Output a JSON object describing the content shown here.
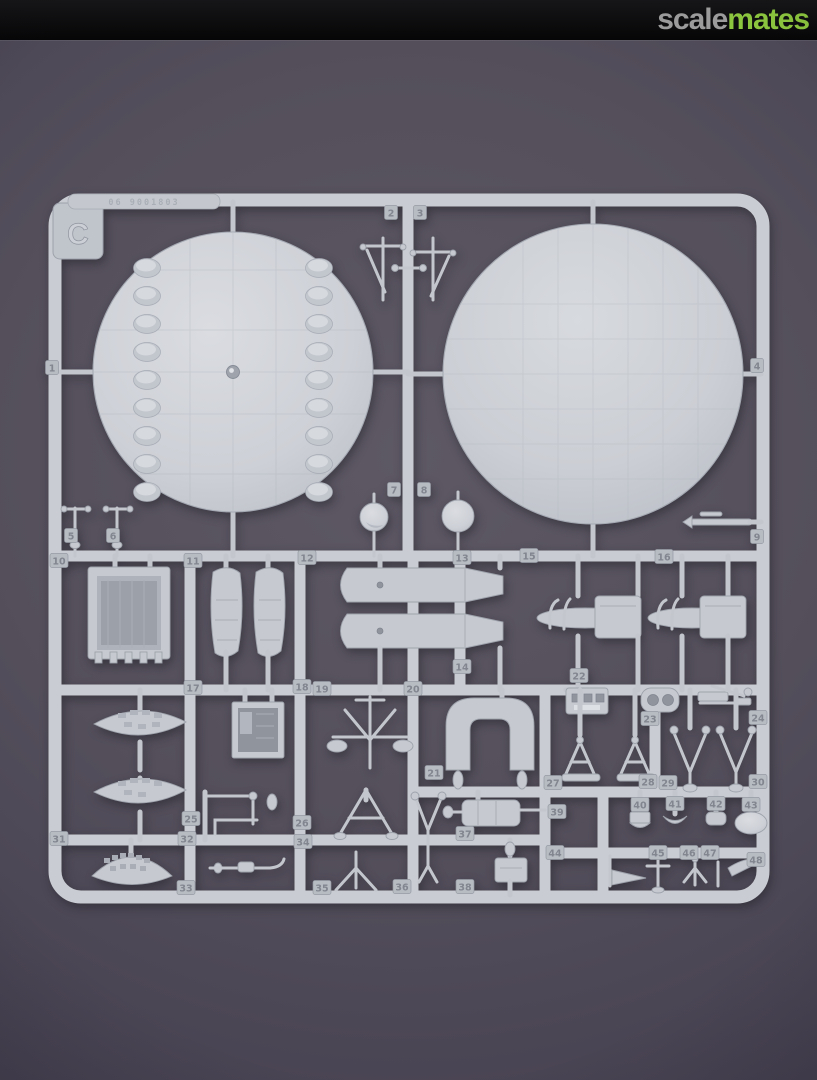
{
  "header": {
    "logo_scale": "scale",
    "logo_mates": "mates",
    "bar_color": "#0b0b0c",
    "scale_color": "#9b9b9b",
    "mates_color": "#8cc63e"
  },
  "background": {
    "center_color": "#5d5864",
    "edge_color": "#393540"
  },
  "sprue": {
    "letter": "C",
    "embossed_code": "06 9001803",
    "plastic_color": "#c9ccd2",
    "plastic_shadow": "#9da2ab",
    "tag_face_color": "#b7bbc2",
    "tag_number_color": "#81868f",
    "part_tags": [
      {
        "label": "1",
        "x": 52,
        "y": 368
      },
      {
        "label": "2",
        "x": 391,
        "y": 213
      },
      {
        "label": "3",
        "x": 420,
        "y": 213
      },
      {
        "label": "4",
        "x": 757,
        "y": 366
      },
      {
        "label": "5",
        "x": 71,
        "y": 536
      },
      {
        "label": "6",
        "x": 113,
        "y": 536
      },
      {
        "label": "7",
        "x": 394,
        "y": 490
      },
      {
        "label": "8",
        "x": 424,
        "y": 490
      },
      {
        "label": "9",
        "x": 757,
        "y": 537
      },
      {
        "label": "10",
        "x": 59,
        "y": 561
      },
      {
        "label": "11",
        "x": 193,
        "y": 561
      },
      {
        "label": "12",
        "x": 307,
        "y": 558
      },
      {
        "label": "13",
        "x": 462,
        "y": 558
      },
      {
        "label": "14",
        "x": 462,
        "y": 667
      },
      {
        "label": "15",
        "x": 529,
        "y": 556
      },
      {
        "label": "16",
        "x": 664,
        "y": 557
      },
      {
        "label": "17",
        "x": 193,
        "y": 688
      },
      {
        "label": "18",
        "x": 302,
        "y": 687
      },
      {
        "label": "19",
        "x": 322,
        "y": 689
      },
      {
        "label": "20",
        "x": 413,
        "y": 689
      },
      {
        "label": "21",
        "x": 434,
        "y": 773
      },
      {
        "label": "22",
        "x": 579,
        "y": 676
      },
      {
        "label": "23",
        "x": 650,
        "y": 719
      },
      {
        "label": "24",
        "x": 758,
        "y": 718
      },
      {
        "label": "25",
        "x": 191,
        "y": 819
      },
      {
        "label": "26",
        "x": 302,
        "y": 823
      },
      {
        "label": "27",
        "x": 553,
        "y": 783
      },
      {
        "label": "28",
        "x": 648,
        "y": 782
      },
      {
        "label": "29",
        "x": 668,
        "y": 783
      },
      {
        "label": "30",
        "x": 758,
        "y": 782
      },
      {
        "label": "31",
        "x": 59,
        "y": 839
      },
      {
        "label": "32",
        "x": 187,
        "y": 839
      },
      {
        "label": "33",
        "x": 186,
        "y": 888
      },
      {
        "label": "34",
        "x": 303,
        "y": 842
      },
      {
        "label": "35",
        "x": 322,
        "y": 888
      },
      {
        "label": "36",
        "x": 402,
        "y": 887
      },
      {
        "label": "37",
        "x": 465,
        "y": 834
      },
      {
        "label": "38",
        "x": 465,
        "y": 887
      },
      {
        "label": "39",
        "x": 557,
        "y": 812
      },
      {
        "label": "40",
        "x": 640,
        "y": 805
      },
      {
        "label": "41",
        "x": 675,
        "y": 804
      },
      {
        "label": "42",
        "x": 716,
        "y": 804
      },
      {
        "label": "43",
        "x": 751,
        "y": 805
      },
      {
        "label": "44",
        "x": 555,
        "y": 853
      },
      {
        "label": "45",
        "x": 658,
        "y": 853
      },
      {
        "label": "46",
        "x": 689,
        "y": 853
      },
      {
        "label": "47",
        "x": 710,
        "y": 853
      },
      {
        "label": "48",
        "x": 756,
        "y": 860
      }
    ]
  }
}
